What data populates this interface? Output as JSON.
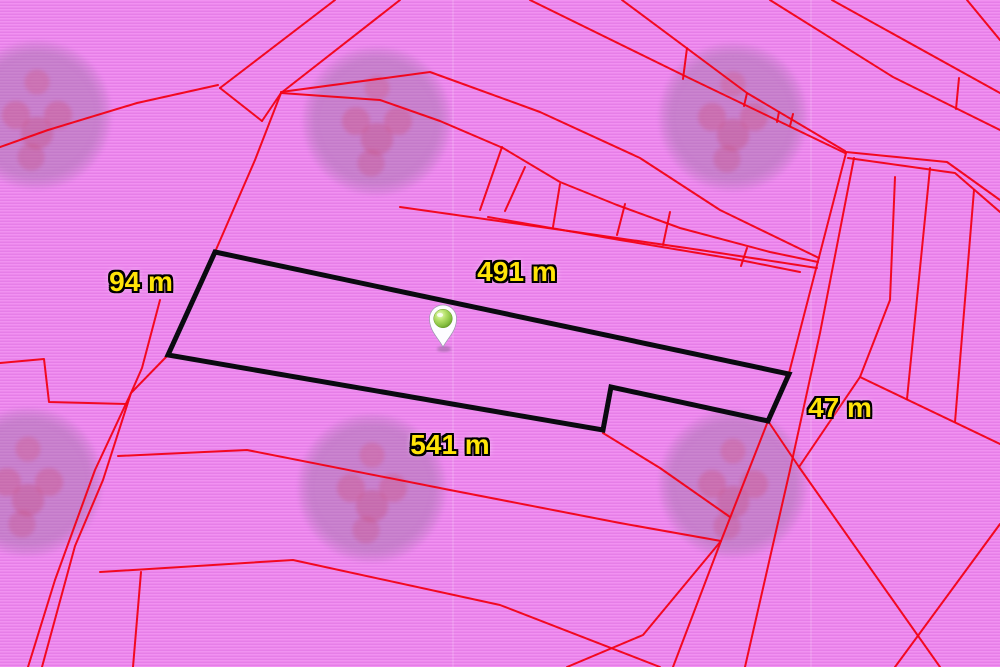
{
  "map": {
    "type": "cadastral-parcel-map",
    "background_color": "#ec87ec",
    "boundary_line_color": "#f20318",
    "highlight_parcel_color": "#0a0a10",
    "label_text_color": "#ffe408",
    "marker": {
      "name": "location-pin-icon",
      "x": 443,
      "y": 347,
      "ball_color": "#8bc34a"
    },
    "labels": [
      {
        "id": "west-side-length",
        "text": "94 m",
        "x": 141,
        "y": 282
      },
      {
        "id": "north-side-length",
        "text": "491 m",
        "x": 517,
        "y": 272
      },
      {
        "id": "south-side-length",
        "text": "541 m",
        "x": 450,
        "y": 445
      },
      {
        "id": "east-side-length",
        "text": "47 m",
        "x": 840,
        "y": 408
      }
    ],
    "highlight_parcel_outline": [
      [
        215,
        252
      ],
      [
        789,
        374
      ],
      [
        768,
        421
      ],
      [
        611,
        387
      ],
      [
        603,
        430
      ],
      [
        168,
        355
      ]
    ],
    "red_lines": [
      [
        [
          0,
          147
        ],
        [
          48,
          130
        ],
        [
          137,
          103
        ],
        [
          218,
          85
        ]
      ],
      [
        [
          335,
          0
        ],
        [
          220,
          88
        ]
      ],
      [
        [
          400,
          0
        ],
        [
          281,
          93
        ],
        [
          262,
          121
        ]
      ],
      [
        [
          220,
          88
        ],
        [
          262,
          121
        ]
      ],
      [
        [
          281,
          93
        ],
        [
          255,
          160
        ],
        [
          215,
          252
        ],
        [
          168,
          355
        ],
        [
          131,
          393
        ],
        [
          103,
          480
        ],
        [
          75,
          546
        ],
        [
          42,
          667
        ]
      ],
      [
        [
          160,
          300
        ],
        [
          142,
          368
        ],
        [
          131,
          393
        ],
        [
          95,
          470
        ],
        [
          55,
          580
        ],
        [
          28,
          667
        ]
      ],
      [
        [
          0,
          363
        ],
        [
          44,
          359
        ],
        [
          49,
          402
        ],
        [
          127,
          404
        ]
      ],
      [
        [
          118,
          456
        ],
        [
          247,
          450
        ],
        [
          450,
          490
        ],
        [
          620,
          523
        ],
        [
          721,
          541
        ]
      ],
      [
        [
          100,
          572
        ],
        [
          293,
          560
        ],
        [
          500,
          605
        ],
        [
          660,
          667
        ]
      ],
      [
        [
          567,
          667
        ],
        [
          643,
          635
        ],
        [
          721,
          541
        ]
      ],
      [
        [
          133,
          667
        ],
        [
          141,
          572
        ]
      ],
      [
        [
          603,
          433
        ],
        [
          660,
          468
        ],
        [
          730,
          517
        ]
      ],
      [
        [
          530,
          0
        ],
        [
          687,
          77
        ],
        [
          845,
          153
        ]
      ],
      [
        [
          622,
          0
        ],
        [
          747,
          93
        ],
        [
          845,
          151
        ]
      ],
      [
        [
          687,
          48
        ],
        [
          683,
          79
        ]
      ],
      [
        [
          747,
          93
        ],
        [
          744,
          106
        ]
      ],
      [
        [
          779,
          112
        ],
        [
          777,
          122
        ]
      ],
      [
        [
          793,
          114
        ],
        [
          790,
          126
        ]
      ],
      [
        [
          281,
          92
        ],
        [
          430,
          72
        ],
        [
          540,
          112
        ],
        [
          640,
          158
        ],
        [
          720,
          210
        ],
        [
          819,
          258
        ]
      ],
      [
        [
          281,
          93
        ],
        [
          380,
          100
        ],
        [
          440,
          121
        ],
        [
          503,
          148
        ],
        [
          560,
          182
        ],
        [
          617,
          205
        ],
        [
          680,
          228
        ],
        [
          770,
          252
        ],
        [
          818,
          262
        ]
      ],
      [
        [
          400,
          207
        ],
        [
          583,
          233
        ],
        [
          700,
          250
        ],
        [
          817,
          268
        ]
      ],
      [
        [
          488,
          217
        ],
        [
          620,
          240
        ],
        [
          740,
          260
        ],
        [
          800,
          272
        ]
      ],
      [
        [
          502,
          147
        ],
        [
          480,
          210
        ]
      ],
      [
        [
          525,
          167
        ],
        [
          505,
          211
        ]
      ],
      [
        [
          560,
          184
        ],
        [
          553,
          227
        ]
      ],
      [
        [
          625,
          204
        ],
        [
          617,
          235
        ]
      ],
      [
        [
          670,
          212
        ],
        [
          663,
          245
        ]
      ],
      [
        [
          747,
          248
        ],
        [
          741,
          266
        ]
      ],
      [
        [
          846,
          152
        ],
        [
          947,
          162
        ],
        [
          1000,
          200
        ]
      ],
      [
        [
          848,
          158
        ],
        [
          955,
          173
        ],
        [
          1000,
          212
        ]
      ],
      [
        [
          846,
          153
        ],
        [
          789,
          373
        ],
        [
          768,
          421
        ],
        [
          721,
          541
        ],
        [
          673,
          667
        ]
      ],
      [
        [
          854,
          158
        ],
        [
          820,
          333
        ],
        [
          790,
          470
        ],
        [
          745,
          667
        ]
      ],
      [
        [
          895,
          177
        ],
        [
          890,
          300
        ],
        [
          860,
          377
        ],
        [
          799,
          467
        ]
      ],
      [
        [
          768,
          421
        ],
        [
          799,
          467
        ]
      ],
      [
        [
          770,
          0
        ],
        [
          893,
          77
        ],
        [
          1000,
          130
        ]
      ],
      [
        [
          832,
          0
        ],
        [
          1000,
          93
        ]
      ],
      [
        [
          959,
          78
        ],
        [
          956,
          109
        ]
      ],
      [
        [
          967,
          0
        ],
        [
          1000,
          40
        ]
      ],
      [
        [
          930,
          168
        ],
        [
          907,
          399
        ]
      ],
      [
        [
          974,
          190
        ],
        [
          955,
          422
        ]
      ],
      [
        [
          860,
          377
        ],
        [
          1000,
          444
        ]
      ],
      [
        [
          799,
          467
        ],
        [
          940,
          667
        ]
      ],
      [
        [
          1000,
          524
        ],
        [
          895,
          667
        ]
      ]
    ],
    "watermarks": [
      {
        "x": 37,
        "y": 115
      },
      {
        "x": 377,
        "y": 121
      },
      {
        "x": 733,
        "y": 117
      },
      {
        "x": 28,
        "y": 482
      },
      {
        "x": 372,
        "y": 488
      },
      {
        "x": 733,
        "y": 484
      }
    ],
    "tile_seams_x": [
      452,
      810
    ]
  }
}
